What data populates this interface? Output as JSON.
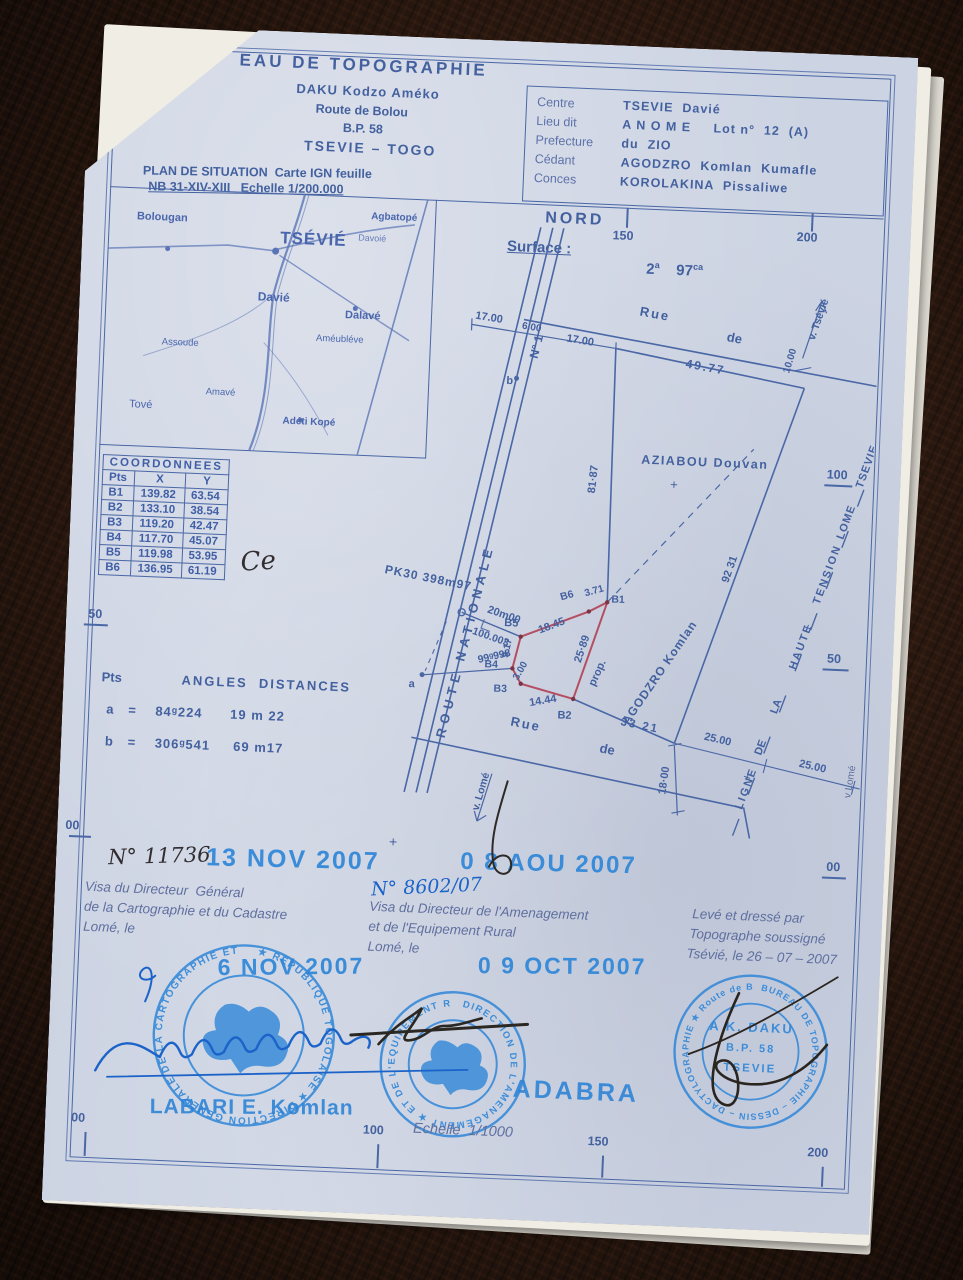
{
  "colors": {
    "paper": "#ccd3e2",
    "ink": "#44619f",
    "stamp_blue": "#2f86d8",
    "plot_red": "#b44f63",
    "pen_blue": "#1b63c8",
    "pen_dark": "#322d30"
  },
  "header": {
    "org": "EAU DE TOPOGRAPHIE",
    "name": "DAKU Kodzo Améko",
    "street": "Route de Bolou",
    "bp": "B.P. 58",
    "city": "TSEVIE – TOGO"
  },
  "info": {
    "rows": [
      {
        "label": "Centre",
        "value": "TSEVIE  Davié"
      },
      {
        "label": "Lieu dit",
        "value": "A N O M E     Lot n°  12  (A)"
      },
      {
        "label": "Prefecture",
        "value": "du  ZIO"
      },
      {
        "label": "Cédant",
        "value": "AGODZRO  Komlan  Kumafle"
      },
      {
        "label": "Conces",
        "value": "KOROLAKINA  Pissaliwe"
      }
    ]
  },
  "plan_situation": {
    "line1": "PLAN DE SITUATION  Carte IGN feuille",
    "line2": "NB 31-XIV-XIII   Echelle 1/200.000"
  },
  "map": {
    "towns": [
      "Bolougan",
      "TSÉVIÉ",
      "Agbatopé",
      "Davoié",
      "Davié",
      "Dalavé",
      "Améubléve",
      "Assoude",
      "Amavé",
      "Adéti Kopé",
      "Tové"
    ]
  },
  "compass": "NORD",
  "surface": {
    "label": "Surface :",
    "v1": "2",
    "u1": "a",
    "v2": "97",
    "u2": "ca"
  },
  "rulers": {
    "top": [
      "150",
      "200"
    ],
    "left": [
      "50",
      "00"
    ],
    "right": [
      "100",
      "50",
      "00"
    ],
    "bottom": [
      "00",
      "100",
      "150",
      "200"
    ],
    "scale": "Echelle  1/1000"
  },
  "coordinates": {
    "title": "COORDONNEES",
    "cols": [
      "Pts",
      "X",
      "Y"
    ],
    "rows": [
      [
        "B1",
        "139.82",
        "63.54"
      ],
      [
        "B2",
        "133.10",
        "38.54"
      ],
      [
        "B3",
        "119.20",
        "42.47"
      ],
      [
        "B4",
        "117.70",
        "45.07"
      ],
      [
        "B5",
        "119.98",
        "53.95"
      ],
      [
        "B6",
        "136.95",
        "61.19"
      ]
    ]
  },
  "angles": {
    "pts": "Pts",
    "title": "ANGLES  DISTANCES",
    "row_a": "a   =    84ᵍ224      19 m 22",
    "row_b": "b   =    306ᵍ541     69 m17"
  },
  "plan": {
    "route": "ROUTE    NATIONALE",
    "n1": "N° 1",
    "b": "b",
    "a": "a",
    "dim17a": "17.00",
    "dim6": "6.00",
    "dim17b": "17.00",
    "rue1": "Rue",
    "rue2": "de",
    "rue_len": "49.77",
    "dim10": "10.00",
    "v_tsevie": "v. Tsévié",
    "aziabou": "AZIABOU  Douvan",
    "plus": "+",
    "d8187": "81·87",
    "d9231": "92 31",
    "d3321": "33 21",
    "d2500": "25.00",
    "d1800": "18·00",
    "rue_b1": "Rue",
    "rue_b2": "de",
    "v_lome": "v. Lomé",
    "v_lome_right": "v Lomé",
    "pk": "PK30  398m97",
    "d20": "20m00",
    "d100": "100.003",
    "d99": "99ᵍ998",
    "b1": "B1",
    "b2": "B2",
    "b3": "B3",
    "b4": "B4",
    "b5": "B5",
    "b6": "B6",
    "e1845": "18.45",
    "e371": "3.71",
    "e2589": "25·89",
    "e1444": "14.44",
    "e300": "3.00",
    "e917": "9.17",
    "prop": "prop.",
    "owner": "AGODZRO  Komlan",
    "ht": [
      "LIGNE",
      "DE",
      "LA",
      "HAUTE",
      "TENSION",
      "LOME",
      "TSEVIE"
    ]
  },
  "visa_left": {
    "number": "N° 11736",
    "date_stamp": "13 NOV 2007",
    "line1": "Visa du Directeur  Général",
    "line2": "de la Cartographie et du Cadastre",
    "line3": "Lomé, le",
    "date_stamp2": "6 NOV 2007",
    "stamp_name": "LABARI E. Komlan",
    "ring": "★ REPUBLIQUE TOGOLAISE ★ DIRECTION GENERALE DE LA CARTOGRAPHIE ET DU CADASTRE"
  },
  "visa_mid": {
    "cross": "+",
    "date_stamp": "0 8 AOU 2007",
    "number": "N° 8602/07",
    "line1": "Visa du Directeur de l'Amenagement",
    "line2": "et de l'Equipement Rural",
    "line3": "Lomé, le",
    "date_stamp2": "0 9 OCT 2007",
    "stamp_name": "ADABRA",
    "ring": "DIRECTION DE L'AMENAGEMENT ★ ET DE L'EQUIPEMENT RURAL ★"
  },
  "dressage": {
    "line1": "Levé et dressé par",
    "line2": "Topographe soussigné",
    "line3": "Tsévié, le 26 – 07 – 2007",
    "ring": "BUREAU DE TOPOGRAPHIE – DESSIN – DACTYLOGRAPHIE ★ Route de BOLOU ★",
    "inner1": "A K. DAKU",
    "inner2": "B.P. 58",
    "inner3": "TSEVIE"
  },
  "annotations": {
    "ce": "Ce"
  }
}
